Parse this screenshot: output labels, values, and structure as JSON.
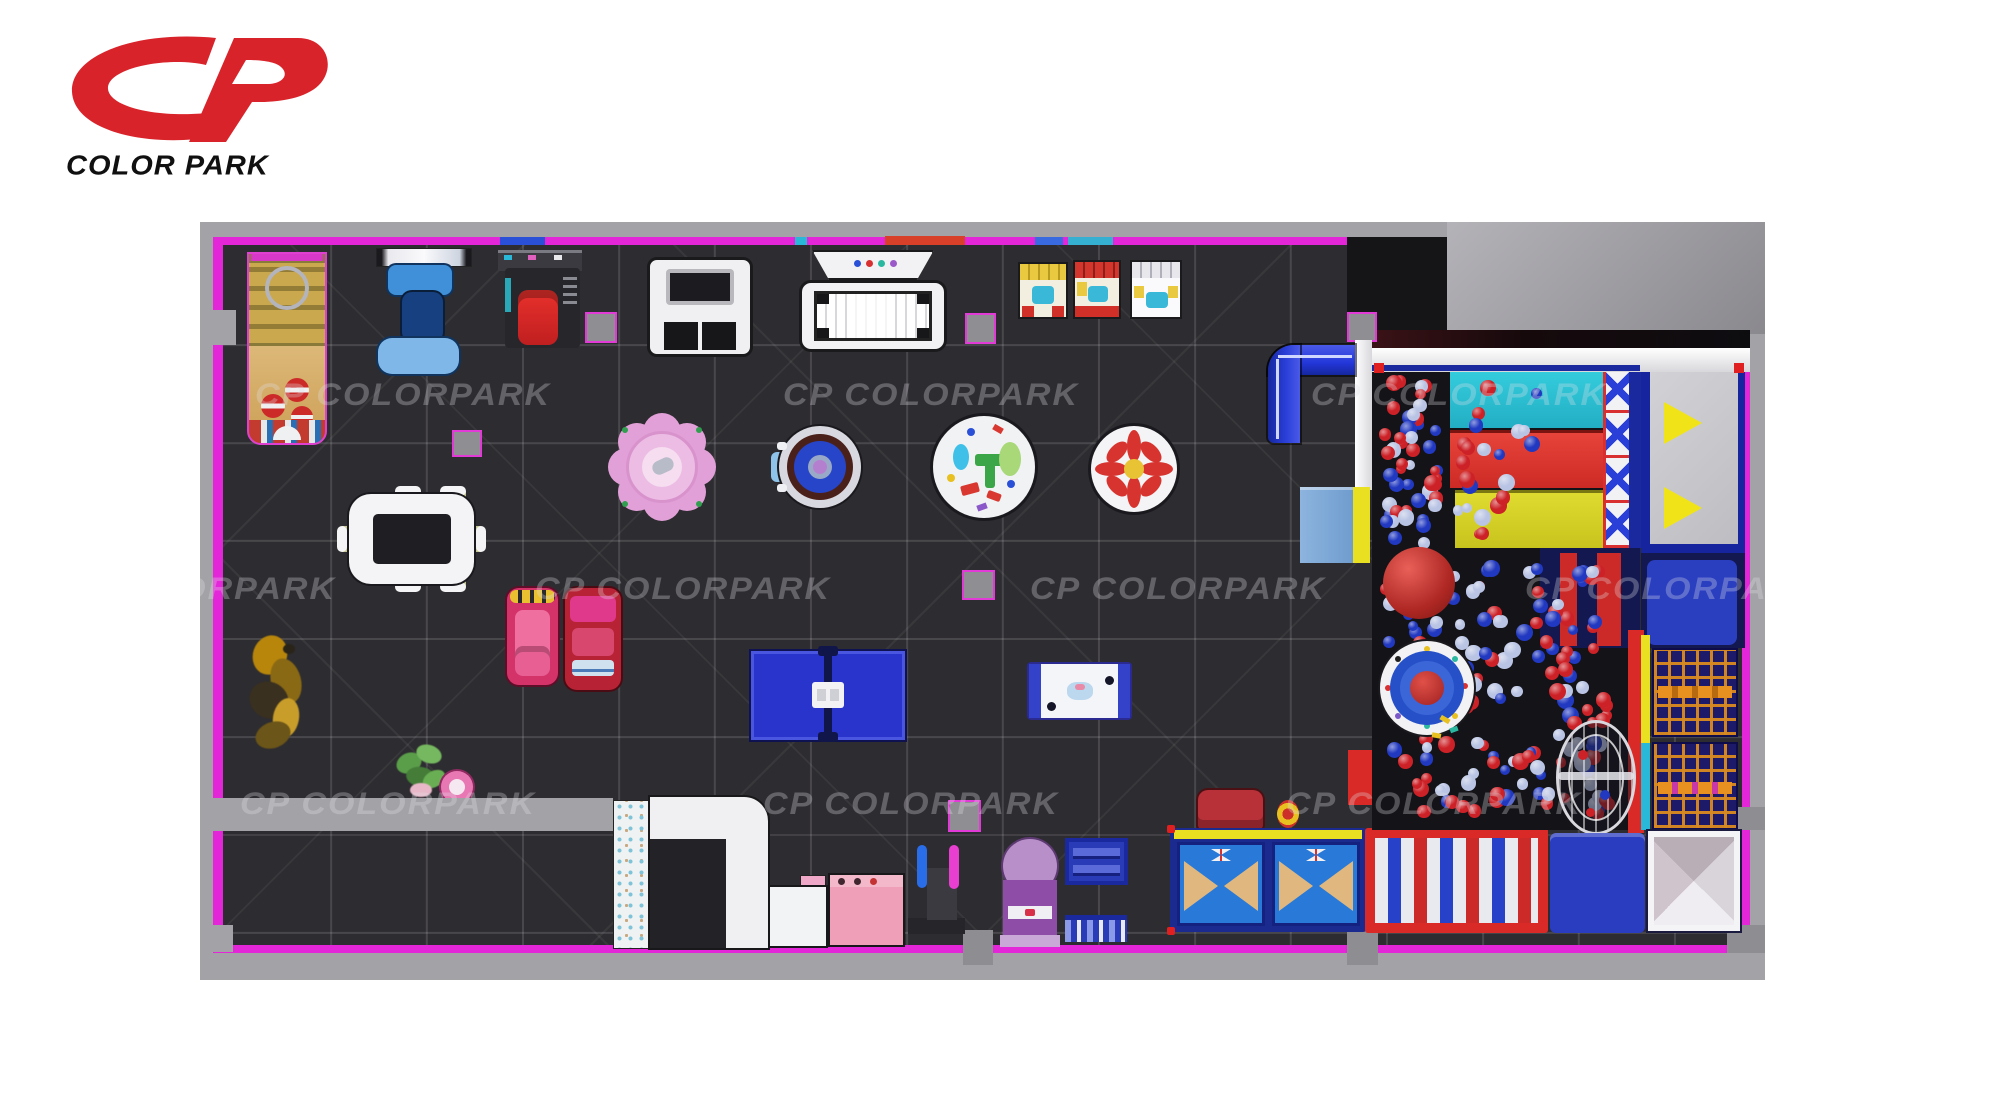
{
  "brand": {
    "monogram": "CP",
    "name": "COLOR PARK",
    "logo_color": "#d9232a",
    "wordmark_color": "#101010"
  },
  "watermark": {
    "text": "CP COLORPARK",
    "color": "rgba(225,225,232,0.30)",
    "rows": [
      {
        "y": 154,
        "xs": [
          55,
          583,
          1111
        ]
      },
      {
        "y": 348,
        "xs": [
          -160,
          335,
          830,
          1325
        ]
      },
      {
        "y": 563,
        "xs": [
          40,
          563,
          1086
        ]
      }
    ]
  },
  "floor_plan": {
    "wall_color": "#a3a2a7",
    "border_color": "#e326d8",
    "floor_color": "#2d2c30",
    "grid_color": "rgba(255,255,255,0.13)",
    "cutout": "top-right service area"
  },
  "ball_pit": {
    "ball_colors": [
      "#cc2127",
      "#2138c0",
      "#b9c4e4"
    ],
    "color_weights": [
      0.38,
      0.34,
      0.28
    ],
    "big_ball_color": "#b02824",
    "regions": [
      {
        "x": 1178,
        "y": 150,
        "w": 67,
        "h": 178,
        "n": 48
      },
      {
        "x": 1178,
        "y": 336,
        "w": 237,
        "h": 262,
        "n": 150
      },
      {
        "x": 1250,
        "y": 150,
        "w": 100,
        "h": 173,
        "n": 22
      }
    ]
  },
  "equipment_inventory": [
    "sand-game-table",
    "kiddie-ride-blue",
    "kiddie-ride-red",
    "claw-machine",
    "white-play-machine",
    "arcade-machine-yellow",
    "arcade-machine-red",
    "arcade-machine-white",
    "flower-trampoline",
    "spinning-ride",
    "toddler-activity-table",
    "pinwheel-carousel",
    "kids-dining-table",
    "tube-slide-blue",
    "ping-pong-table",
    "air-hockey-table",
    "bumper-car-pink",
    "bumper-car-red",
    "bumblebee-statue",
    "potted-plant",
    "kids-stool",
    "reception-counter",
    "shoe-cabinet-white",
    "shoe-cabinet-pink",
    "entry-gate",
    "gumball-machine",
    "display-shelf-upper",
    "display-shelf-lower",
    "climbing-panel-box",
    "kids-chair-red",
    "ring-stacker",
    "roller-bed",
    "ball-pit",
    "slide-cyan",
    "slide-red",
    "slide-yellow",
    "lattice-climb-wall",
    "landing-platform",
    "target-trampoline",
    "giant-red-ball",
    "wire-cage-climber",
    "climbing-net-panels",
    "pyramid-climber",
    "crash-mat-blue",
    "padded-platform"
  ]
}
